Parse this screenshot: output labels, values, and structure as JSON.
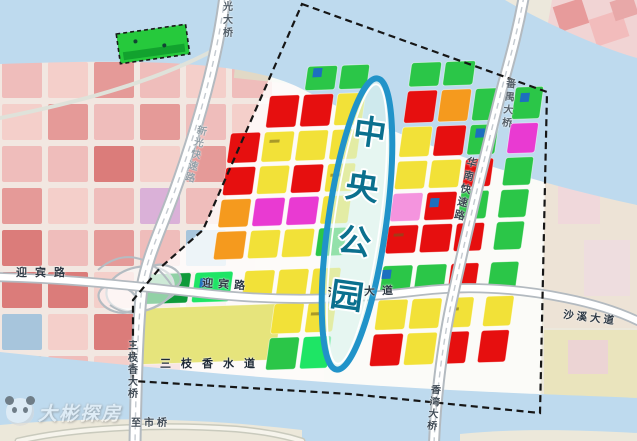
{
  "canvas": {
    "width": 637,
    "height": 441
  },
  "water": {
    "color": "#bedaee",
    "top_path": "M0,0 L505,0 C540,20 592,45 637,58 L637,205 C520,180 400,140 300,88 C240,58 120,60 0,64 Z",
    "bottom_path": "M0,352 C150,368 300,382 450,390 C550,395 600,396 637,398 L637,441 L0,441 Z",
    "south_strip_path": "M0,425 C100,416 200,418 302,430 L302,441 L0,441 Z",
    "south_strip_right_path": "M460,441 L460,434 C520,428 580,430 637,433 L637,441 Z",
    "strip_color": "#ece8da"
  },
  "faded_city": {
    "x": 2,
    "y": 62,
    "cell_w": 40,
    "cell_h": 36,
    "gap": 6,
    "opacity": 0.85,
    "base": "#f4e7e2",
    "palette": {
      "P": "#f0b6b6",
      "S": "#f6cbc8",
      "R": "#e48d8d",
      "D": "#d96a6a",
      "O": "#efb48c",
      "B": "#9cc0dc",
      "V": "#d8a8d8",
      "G": "#b9d8ae",
      "_": null
    },
    "rows": [
      [
        "P",
        "S",
        "R",
        "P",
        "S",
        "P",
        "_"
      ],
      [
        "S",
        "R",
        "P",
        "R",
        "P",
        "S",
        "_"
      ],
      [
        "P",
        "P",
        "D",
        "S",
        "R",
        "_",
        "_"
      ],
      [
        "R",
        "S",
        "P",
        "V",
        "P",
        "_",
        "_"
      ],
      [
        "D",
        "P",
        "R",
        "P",
        "B",
        "_",
        "_"
      ],
      [
        "D",
        "D",
        "S",
        "R",
        "P",
        "_",
        "_"
      ],
      [
        "B",
        "S",
        "D",
        "P",
        "O",
        "_",
        "_"
      ],
      [
        "O",
        "P",
        "S",
        "D",
        "_",
        "_",
        "_"
      ]
    ]
  },
  "districts": [
    {
      "x": 545,
      "y": -12,
      "w": 100,
      "h": 112,
      "c": "#f1d4d4",
      "rot": 10,
      "op": 1
    },
    {
      "x": 556,
      "y": 2,
      "w": 30,
      "h": 26,
      "c": "#e79b9b",
      "rot": -18,
      "op": 1
    },
    {
      "x": 592,
      "y": 14,
      "w": 34,
      "h": 28,
      "c": "#f2bcbc",
      "rot": -18,
      "op": 1
    },
    {
      "x": 612,
      "y": -2,
      "w": 24,
      "h": 20,
      "c": "#e8a8a8",
      "rot": -18,
      "op": 1
    },
    {
      "x": 544,
      "y": 150,
      "w": 95,
      "h": 178,
      "c": "#ede3d6",
      "rot": 0,
      "op": 1
    },
    {
      "x": 558,
      "y": 178,
      "w": 42,
      "h": 46,
      "c": "#f3cfe0",
      "rot": 0,
      "op": 0.55
    },
    {
      "x": 584,
      "y": 240,
      "w": 46,
      "h": 56,
      "c": "#f0d8e8",
      "rot": 0,
      "op": 0.5
    },
    {
      "x": 544,
      "y": 330,
      "w": 95,
      "h": 68,
      "c": "#eae4bd",
      "rot": 0,
      "op": 1
    },
    {
      "x": 568,
      "y": 340,
      "w": 40,
      "h": 34,
      "c": "#ecc9e2",
      "rot": 0,
      "op": 0.6
    },
    {
      "x": 236,
      "y": 36,
      "w": 190,
      "h": 52,
      "c": "#d9e8cd",
      "rot": 6,
      "op": 0.65
    },
    {
      "x": 300,
      "y": 70,
      "w": 120,
      "h": 30,
      "c": "#cfe3c4",
      "rot": 6,
      "op": 0.5
    }
  ],
  "green_parcel": {
    "x": 118,
    "y": 29,
    "w": 70,
    "h": 30,
    "rot": -8,
    "fill": "#26c93c",
    "shade": "#12a22e",
    "dash": "#1a1a1a"
  },
  "plan": {
    "transform": "translate(150,72) rotate(-2) skewX(-10)",
    "palette": {
      "R": "#e60f0f",
      "Y": "#f2e138",
      "O": "#f59a1e",
      "G": "#2bc648",
      "L": "#1ee565",
      "D": "#0f9a3a",
      "M": "#e93ad2",
      "K": "#f494de",
      "B": "#1d6fc0",
      "E": "#e6e47c"
    },
    "parcels": [
      [
        158,
        0,
        30,
        24,
        "G"
      ],
      [
        192,
        0,
        28,
        24,
        "G"
      ],
      [
        262,
        0,
        30,
        24,
        "G"
      ],
      [
        296,
        0,
        30,
        24,
        "G"
      ],
      [
        124,
        28,
        30,
        32,
        "R"
      ],
      [
        158,
        28,
        30,
        32,
        "R"
      ],
      [
        192,
        28,
        28,
        32,
        "Y"
      ],
      [
        262,
        28,
        30,
        32,
        "R"
      ],
      [
        296,
        28,
        30,
        32,
        "O"
      ],
      [
        330,
        28,
        28,
        32,
        "G"
      ],
      [
        370,
        28,
        28,
        32,
        "G"
      ],
      [
        90,
        64,
        30,
        30,
        "R"
      ],
      [
        124,
        64,
        30,
        30,
        "Y"
      ],
      [
        158,
        64,
        30,
        30,
        "Y"
      ],
      [
        192,
        64,
        28,
        30,
        "Y"
      ],
      [
        262,
        64,
        30,
        30,
        "Y"
      ],
      [
        296,
        64,
        30,
        30,
        "R"
      ],
      [
        330,
        64,
        28,
        30,
        "G"
      ],
      [
        370,
        64,
        28,
        30,
        "M"
      ],
      [
        90,
        98,
        30,
        28,
        "R"
      ],
      [
        124,
        98,
        30,
        28,
        "Y"
      ],
      [
        158,
        98,
        30,
        28,
        "R"
      ],
      [
        192,
        98,
        28,
        28,
        "Y"
      ],
      [
        262,
        98,
        30,
        28,
        "Y"
      ],
      [
        296,
        98,
        30,
        28,
        "Y"
      ],
      [
        330,
        98,
        28,
        28,
        "R"
      ],
      [
        370,
        98,
        28,
        28,
        "G"
      ],
      [
        90,
        130,
        30,
        28,
        "O"
      ],
      [
        124,
        130,
        30,
        28,
        "M"
      ],
      [
        158,
        130,
        30,
        28,
        "M"
      ],
      [
        192,
        130,
        28,
        28,
        "Y"
      ],
      [
        262,
        130,
        30,
        28,
        "K"
      ],
      [
        296,
        130,
        30,
        28,
        "R"
      ],
      [
        330,
        130,
        28,
        28,
        "G"
      ],
      [
        370,
        130,
        28,
        28,
        "G"
      ],
      [
        90,
        162,
        30,
        28,
        "O"
      ],
      [
        124,
        162,
        30,
        28,
        "Y"
      ],
      [
        158,
        162,
        30,
        28,
        "Y"
      ],
      [
        192,
        162,
        28,
        28,
        "G"
      ],
      [
        262,
        162,
        30,
        28,
        "R"
      ],
      [
        296,
        162,
        30,
        28,
        "R"
      ],
      [
        330,
        162,
        28,
        28,
        "R"
      ],
      [
        370,
        162,
        28,
        28,
        "G"
      ],
      [
        26,
        202,
        44,
        30,
        "D"
      ],
      [
        74,
        202,
        38,
        30,
        "L"
      ],
      [
        124,
        202,
        30,
        30,
        "Y"
      ],
      [
        158,
        202,
        30,
        30,
        "Y"
      ],
      [
        192,
        202,
        28,
        30,
        "Y"
      ],
      [
        262,
        202,
        30,
        30,
        "G"
      ],
      [
        296,
        202,
        30,
        30,
        "G"
      ],
      [
        330,
        202,
        28,
        30,
        "R"
      ],
      [
        370,
        202,
        28,
        30,
        "G"
      ],
      [
        26,
        236,
        140,
        56,
        "E"
      ],
      [
        158,
        236,
        30,
        30,
        "Y"
      ],
      [
        192,
        236,
        28,
        30,
        "Y"
      ],
      [
        262,
        236,
        30,
        30,
        "Y"
      ],
      [
        296,
        236,
        30,
        30,
        "Y"
      ],
      [
        330,
        236,
        28,
        30,
        "Y"
      ],
      [
        370,
        236,
        28,
        30,
        "Y"
      ],
      [
        158,
        270,
        30,
        32,
        "G"
      ],
      [
        192,
        270,
        28,
        32,
        "L"
      ],
      [
        262,
        270,
        30,
        32,
        "R"
      ],
      [
        296,
        270,
        30,
        32,
        "Y"
      ],
      [
        330,
        270,
        28,
        32,
        "R"
      ],
      [
        370,
        270,
        28,
        32,
        "R"
      ]
    ],
    "chips": [
      [
        376,
        34
      ],
      [
        300,
        136
      ],
      [
        80,
        208
      ],
      [
        164,
        2
      ],
      [
        262,
        206
      ],
      [
        336,
        68
      ]
    ],
    "marks": [
      [
        196,
        108
      ],
      [
        268,
        170
      ],
      [
        334,
        246
      ],
      [
        130,
        72
      ],
      [
        196,
        246
      ]
    ]
  },
  "roads": {
    "casing": "#b3bac0",
    "surface": "#ffffff",
    "lane": "#c4cad0",
    "list": [
      {
        "id": "shore-road",
        "d": "M0,118 C70,104 150,84 214,50",
        "cw": 0,
        "rw": 4,
        "road": "#dfe2da",
        "lane": false
      },
      {
        "id": "shiqiao-road",
        "d": "M18,441 C70,429 150,423 236,429 C268,432 286,436 302,441",
        "cw": 7,
        "rw": 4,
        "road": "#f6f4ec",
        "casing": "#c9cabd",
        "lane": false
      },
      {
        "id": "xinguang-expressway-road",
        "d": "M225,-4 C217,60 197,130 173,196 C158,236 147,258 142,288 C138,320 136,380 135,444",
        "cw": 13,
        "rw": 9,
        "lane": true
      },
      {
        "id": "yingbin-shaxi-road",
        "d": "M-4,277 C80,279 140,287 200,293 C280,302 345,300 420,291 C470,285 520,289 565,298 C600,305 622,313 640,322",
        "cw": 10,
        "rw": 6.5,
        "lane": false
      },
      {
        "id": "huanan-expressway-road",
        "d": "M524,-4 C516,40 507,68 501,92 C487,148 467,230 452,300 C444,336 436,392 434,444",
        "cw": 12,
        "rw": 8,
        "lane": true
      }
    ]
  },
  "interchange": {
    "stroke": "#b4bcc2",
    "ellipses": [
      [
        140,
        289,
        34,
        22,
        -12
      ],
      [
        118,
        299,
        20,
        13,
        18
      ],
      [
        163,
        277,
        18,
        12,
        12
      ]
    ],
    "ramps": [
      "M98,270 C120,250 150,252 172,286",
      "M110,305 C130,320 152,312 176,293"
    ]
  },
  "boundary": {
    "points": "302,4 547,92 540,413 350,394 133,381 133,300 160,268 203,230",
    "color": "#161616"
  },
  "park": {
    "label": "中央公园",
    "ellipse": [
      357,
      224,
      29,
      147,
      8
    ],
    "ring": "#2193c9",
    "inner": "#ffffff",
    "fill": "rgba(216,244,236,0.6)",
    "text_color": "#0b708e"
  },
  "labels": [
    {
      "id": "guangda-bridge",
      "t": "光大桥",
      "x": 220,
      "y": 1,
      "v": 1,
      "rot": 0,
      "size": 10,
      "ls": 3,
      "c": "#525e68"
    },
    {
      "id": "xinguang-expressway",
      "t": "新光快速路",
      "x": 188,
      "y": 124,
      "v": 1,
      "rot": 14,
      "size": 10,
      "ls": 2,
      "c": "#94a0a8"
    },
    {
      "id": "panyu-bridge",
      "t": "番禺大桥",
      "x": 501,
      "y": 78,
      "v": 1,
      "rot": 6,
      "size": 10,
      "ls": 3,
      "c": "#55606a"
    },
    {
      "id": "huanan-expressway",
      "t": "华南快速路",
      "x": 459,
      "y": 156,
      "v": 1,
      "rot": 13,
      "size": 10.5,
      "ls": 3,
      "c": "#3e4954"
    },
    {
      "id": "yingbin-road-west",
      "t": "迎宾路",
      "x": 16,
      "y": 268,
      "v": 0,
      "rot": 0,
      "size": 11,
      "ls": 8,
      "c": "#2e3944"
    },
    {
      "id": "yingbin-road-center",
      "t": "迎宾路",
      "x": 202,
      "y": 280,
      "v": 0,
      "rot": 4,
      "size": 11,
      "ls": 5,
      "c": "#2e3944"
    },
    {
      "id": "shaxi-avenue-center",
      "t": "沙溪大道",
      "x": 328,
      "y": 287,
      "v": 0,
      "rot": -2,
      "size": 11,
      "ls": 7,
      "c": "#2e3944"
    },
    {
      "id": "shaxi-avenue-east",
      "t": "沙溪大道",
      "x": 563,
      "y": 313,
      "v": 0,
      "rot": 7,
      "size": 10.5,
      "ls": 3,
      "c": "#2e3944"
    },
    {
      "id": "sanzhixiang-waterway",
      "t": "三枝香水道",
      "x": 160,
      "y": 359,
      "v": 0,
      "rot": 0,
      "size": 11,
      "ls": 10,
      "c": "#1e2936"
    },
    {
      "id": "sanzhixiang-bridge",
      "t": "三枝香大桥",
      "x": 125,
      "y": 340,
      "v": 1,
      "rot": 0,
      "size": 10,
      "ls": 2,
      "c": "#3e4954"
    },
    {
      "id": "xiangwan-bridge",
      "t": "香湾大桥",
      "x": 426,
      "y": 384,
      "v": 1,
      "rot": 6,
      "size": 10,
      "ls": 2,
      "c": "#3e4954"
    },
    {
      "id": "to-shiqiao",
      "t": "至市桥",
      "x": 131,
      "y": 419,
      "v": 0,
      "rot": 0,
      "size": 10,
      "ls": 3,
      "c": "#3e4954"
    }
  ],
  "watermark": {
    "text": "大彬探房"
  }
}
